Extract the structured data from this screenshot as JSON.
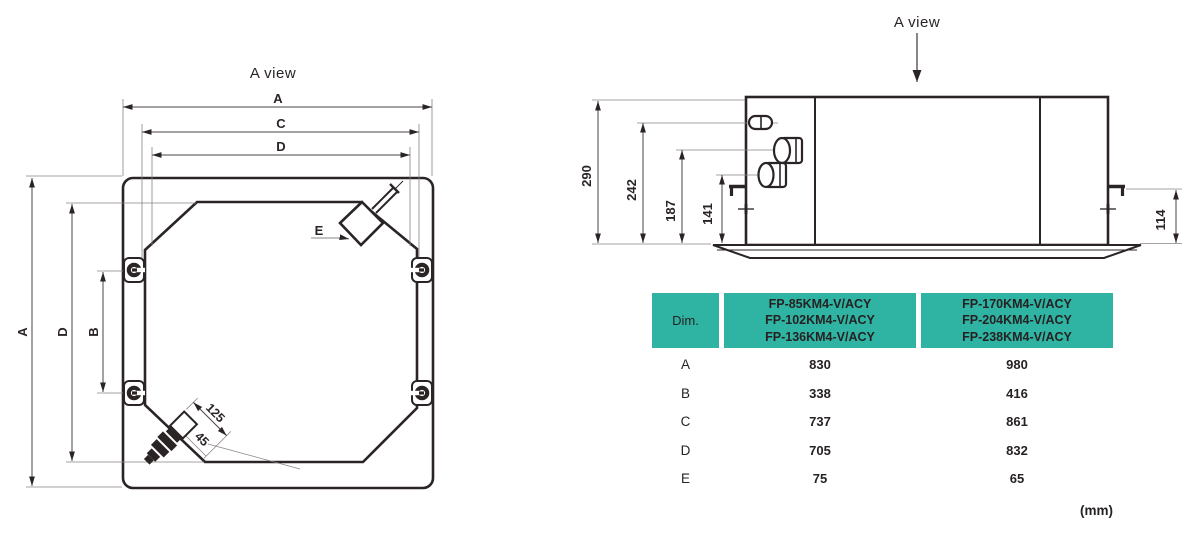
{
  "drawing": {
    "left_view": {
      "title": "A view",
      "dim_top_a": "A",
      "dim_top_c": "C",
      "dim_top_d": "D",
      "dim_left_a": "A",
      "dim_left_d": "D",
      "dim_left_b": "B",
      "connector_label": "E",
      "dim_125": "125",
      "dim_45": "45"
    },
    "right_view": {
      "title": "A view",
      "dim_290": "290",
      "dim_242": "242",
      "dim_187": "187",
      "dim_141": "141",
      "dim_114": "114"
    }
  },
  "table": {
    "header": {
      "dim": "Dim.",
      "models_small": "FP-85KM4-V/ACY\nFP-102KM4-V/ACY\nFP-136KM4-V/ACY",
      "models_large": "FP-170KM4-V/ACY\nFP-204KM4-V/ACY\nFP-238KM4-V/ACY"
    },
    "rows": [
      {
        "dim": "A",
        "small": "830",
        "large": "980"
      },
      {
        "dim": "B",
        "small": "338",
        "large": "416"
      },
      {
        "dim": "C",
        "small": "737",
        "large": "861"
      },
      {
        "dim": "D",
        "small": "705",
        "large": "832"
      },
      {
        "dim": "E",
        "small": "75",
        "large": "65"
      }
    ]
  },
  "unit_note": "(mm)",
  "colors": {
    "header_teal": "#2fb3a2",
    "row_light": "#f1f2f6",
    "row_light_dim": "#e9eaee",
    "row_dark": "#e4e5e9",
    "row_dark_dim": "#dfe0e4",
    "line_dark": "#2a2425",
    "line_thin": "#7a7472",
    "text": "#262223"
  }
}
